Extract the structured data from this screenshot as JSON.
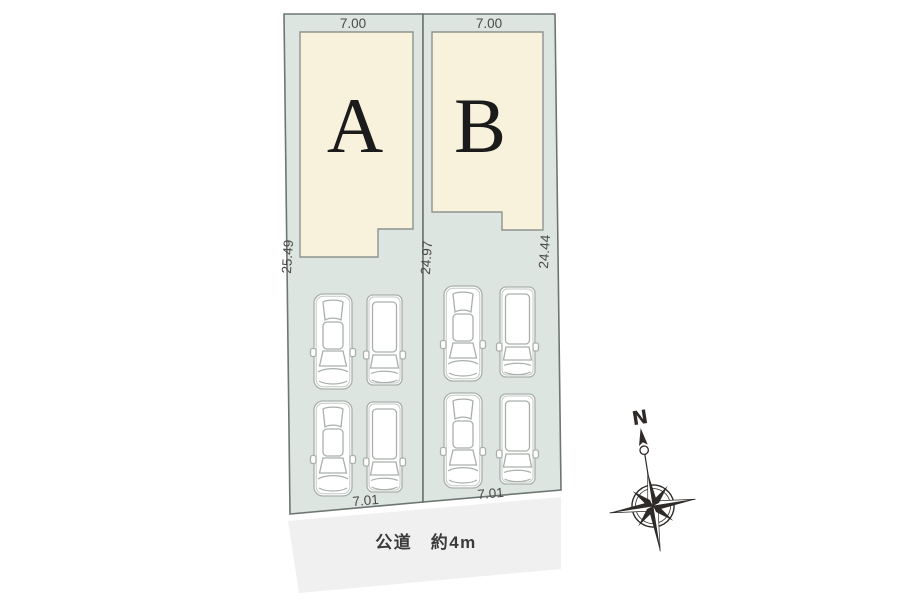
{
  "site_plan": {
    "title": "residential-lot-layout",
    "lots": [
      {
        "name": "A",
        "top_width_m": "7.00",
        "bottom_width_m": "7.01"
      },
      {
        "name": "B",
        "top_width_m": "7.00",
        "bottom_width_m": "7.01"
      }
    ],
    "depths": {
      "left_m": "25.49",
      "center_m": "24.97",
      "right_m": "24.44"
    },
    "road": {
      "label": "公道　約4m"
    },
    "compass": {
      "north": "N"
    },
    "parking": {
      "cars_per_lot": 4
    },
    "icons": {
      "compass": "compass-rose-icon",
      "car_types": [
        "sedan-top-view",
        "minivan-top-view"
      ]
    },
    "colors": {
      "lot_fill": "#dde5e1",
      "building_fill": "#f8f2dd",
      "road_fill": "#f0f0f0",
      "lot_outline": "#6d7672",
      "building_outline": "#8d948e",
      "car_outline": "#a9b0ac",
      "dimension_text": "#4a4a4a",
      "letter_text": "#1b1b1b",
      "compass_ink": "#2e2a27"
    }
  }
}
